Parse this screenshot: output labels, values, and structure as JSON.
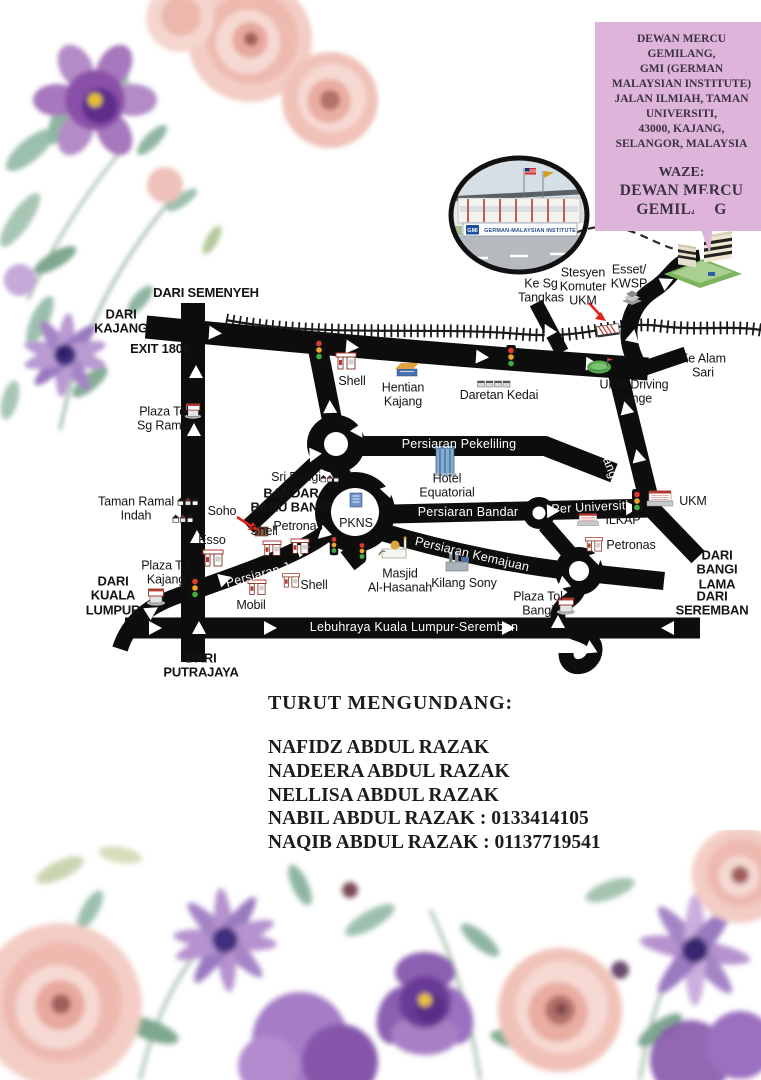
{
  "info_box": {
    "address": "DEWAN MERCU\nGEMILANG,\nGMI (GERMAN\nMALAYSIAN INSTITUTE)\nJALAN ILMIAH, TAMAN\nUNIVERSITI,\n43000, KAJANG,\nSELANGOR, MALAYSIA",
    "waze_label": "WAZE:",
    "waze_value": "DEWAN MERCU\nGEMILANG",
    "bg_color": "#dfb4da"
  },
  "photo": {
    "sign_logo": "GMI",
    "sign_text": "GERMAN-MALAYSIAN INSTITUTE"
  },
  "map": {
    "labels": {
      "dari_semenyeh": "DARI SEMENYEH",
      "dari_kajang": "DARI\nKAJANG",
      "exit_1806": "EXIT 1806",
      "plaza_tol_sg_ramal": "Plaza Tol\nSg Ramal",
      "taman_ramal_indah": "Taman Ramal\nIndah",
      "dari_kuala_lumpur": "DARI\nKUALA\nLUMPUR",
      "plaza_tol_kajang": "Plaza Tol\nKajang",
      "soho": "Soho",
      "esso": "Esso",
      "shell_soho": "Shell",
      "petronas_bandar": "Petronas",
      "bandar_baru_bangi": "BANDAR\nBARU BANGI",
      "sri_bangi": "Sri Bangi",
      "shell_top": "Shell",
      "hentian_kajang": "Hentian\nKajang",
      "daretan_kedai": "Daretan Kedai",
      "ukm_driving_range": "UKM Driving\nRange",
      "ke_alam_sari": "Ke Alam\nSari",
      "ke_sg_tangkas": "Ke Sg\nTangkas",
      "stesyen_komuter_ukm": "Stesyen\nKomuter\nUKM",
      "esset_kwsp": "Esset/\nKWSP",
      "hotel_equatorial": "Hotel\nEquatorial",
      "pkns": "PKNS",
      "persiaran_pekeliling": "Persiaran Pekeliling",
      "persiaran_bandar": "Persiaran Bandar",
      "persiaran_kemajuan": "Persiaran Kemajuan",
      "persiaran_jaya": "Persiaran Jaya",
      "per_universiti": "Per Universiti",
      "persiaran_bangi": "Persiaran Bangi",
      "lebuhraya": "Lebuhraya Kuala Lumpur-Seremban",
      "ukm": "UKM",
      "ilkap": "ILKAP",
      "petronas_ilkap": "Petronas",
      "dari_bangi_lama": "DARI\nBANGI LAMA",
      "dari_seremban": "DARI SEREMBAN",
      "dari_putrajaya": "DARI\nPUTRAJAYA",
      "masjid": "Masjid\nAl-Hasanah",
      "kilang_sony": "Kilang Sony",
      "mobil": "Mobil",
      "shell_jaya": "Shell",
      "plaza_tol_bangi": "Plaza Tol\nBangi"
    },
    "icons": {
      "traffic-light-icon": "3-lamp signal box",
      "gas-station-icon": "fuel pump under canopy",
      "toll-plaza-icon": "toll booth",
      "railway-icon": "hatched railway track",
      "roundabout-icon": "ring junction",
      "houses-icon": "terrace house row",
      "shops-icon": "shop row",
      "bus-terminal-icon": "roofed terminal",
      "hotel-icon": "glass tower",
      "mosque-icon": "domed mosque with minaret",
      "factory-icon": "factory with stacks",
      "train-station-icon": "striped platform shed",
      "stepped-building-icon": "stepped pyramid block",
      "driving-range-icon": "green with flag",
      "campus-building-icon": "red-roof building",
      "gmi-building-icon": "isometric campus block on green base",
      "direction-arrow-icon": "white chevron",
      "pointer-arrow-icon": "red arrow",
      "dashed-link-icon": "dashed curved connector"
    }
  },
  "invite": {
    "heading": "TURUT MENGUNDANG:",
    "names": [
      "NAFIDZ ABDUL RAZAK",
      "NADEERA ABDUL RAZAK",
      "NELLISA ABDUL RAZAK",
      "NABIL ABDUL RAZAK  : 0133414105",
      "NAQIB ABDUL RAZAK : 01137719541"
    ]
  },
  "palette": {
    "road": "#0d0d0d",
    "info_box_bg": "#dfb4da",
    "arrow_red": "#e0241b",
    "signal_red": "#e03a2f",
    "signal_amber": "#f0a32a",
    "signal_green": "#41b044",
    "rose_pink": "#f0c5bd",
    "flower_purple": "#a678bd",
    "flower_deep_purple": "#5e2f8a",
    "flower_center_yellow": "#e8c02a",
    "leaf_green": "#9dbfae"
  }
}
